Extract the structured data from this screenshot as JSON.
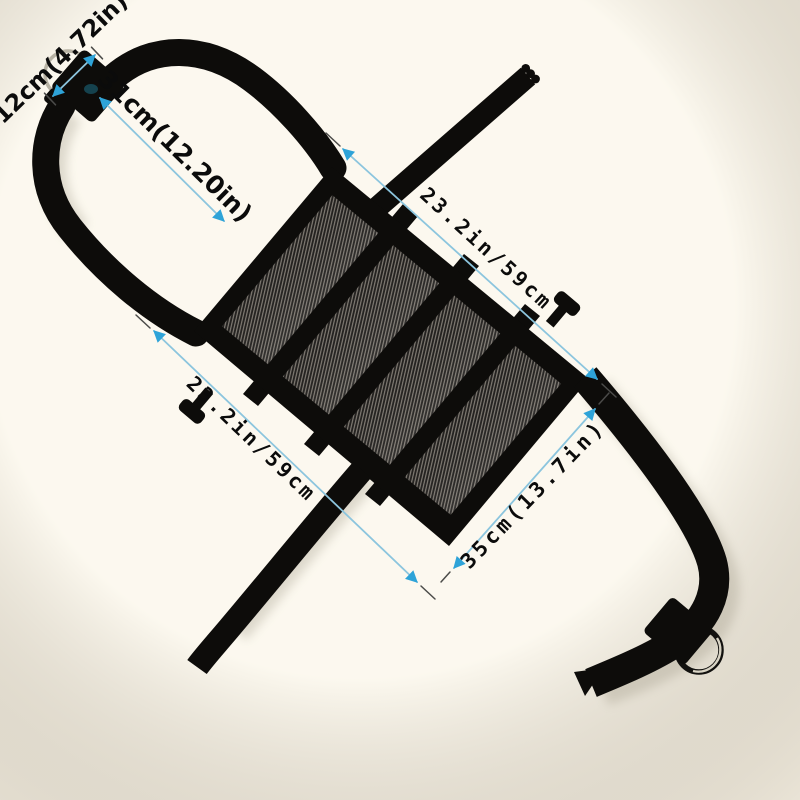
{
  "scene": {
    "background": "#f9f4e8",
    "product_color": "#0d0c0a",
    "mesh_base": "#23211f",
    "mesh_line": "#837e76",
    "dim_line_color": "#8cc5de",
    "dim_arrow_color": "#2ea3d8",
    "dim_tick_color": "#4b4b49",
    "dim_text_color": "#0b0b0b"
  },
  "annotations": {
    "strap_loop_width": {
      "label": "12cm(4.72in)"
    },
    "strap_length": {
      "label": "31cm(12.20in)"
    },
    "panel_length_top": {
      "label": "23.2in/59cm"
    },
    "panel_length_bottom": {
      "label": "23.2in/59cm"
    },
    "panel_width": {
      "label": "35cm(13.7in)"
    }
  }
}
